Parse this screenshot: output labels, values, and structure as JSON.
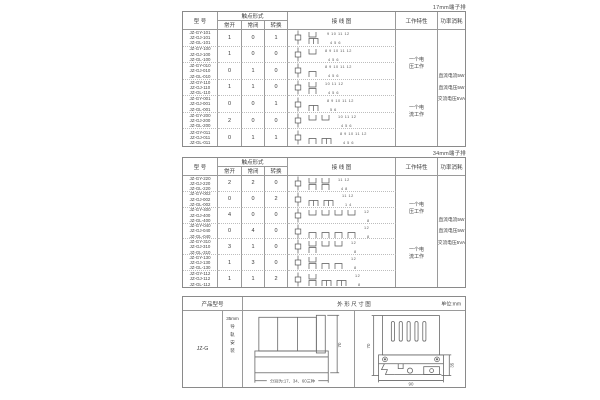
{
  "colors": {
    "border": "#8a8a8a",
    "grid_line": "#9a9a9a",
    "dotted_line": "#bdbdbd",
    "text": "#3a3a3a",
    "diagram": "#555555"
  },
  "spec_headers": {
    "model": "型 号",
    "contact": "触点形式",
    "no": "常开",
    "nc": "常闭",
    "co": "转换",
    "wiring": "接 线 图",
    "working": "工作特性",
    "power": "功率消耗"
  },
  "tables": [
    {
      "note": "17mm端子排",
      "rows": [
        {
          "models": [
            "JZ-GY-101",
            "JZ-GJ-101",
            "JZ-GL-101"
          ],
          "no": "1",
          "nc": "0",
          "co": "1",
          "diagram": {
            "no": 1,
            "nc": 0,
            "co": 1,
            "top_terminals": "9 10 11 12",
            "bottom_terminals": "4 5 6"
          }
        },
        {
          "models": [
            "JZ-GY-100",
            "JZ-GJ-100",
            "JZ-GL-100"
          ],
          "no": "1",
          "nc": "0",
          "co": "0",
          "diagram": {
            "no": 1,
            "nc": 0,
            "co": 0,
            "top_terminals": "8 9 10 11 12",
            "bottom_terminals": "4 5 6"
          }
        },
        {
          "models": [
            "JZ-GY-010",
            "JZ-GJ-010",
            "JZ-GL-010"
          ],
          "no": "0",
          "nc": "1",
          "co": "0",
          "diagram": {
            "no": 0,
            "nc": 1,
            "co": 0,
            "top_terminals": "8 9 10 11 12",
            "bottom_terminals": "4 5 6"
          }
        },
        {
          "models": [
            "JZ-GY-110",
            "JZ-GJ-110",
            "JZ-GL-110"
          ],
          "no": "1",
          "nc": "1",
          "co": "0",
          "diagram": {
            "no": 1,
            "nc": 1,
            "co": 0,
            "top_terminals": "10 11 12",
            "bottom_terminals": "4 5 6"
          }
        },
        {
          "models": [
            "JZ-GY-001",
            "JZ-GJ-001",
            "JZ-GL-001"
          ],
          "no": "0",
          "nc": "0",
          "co": "1",
          "diagram": {
            "no": 0,
            "nc": 0,
            "co": 1,
            "top_terminals": "8 9 10 11 12",
            "bottom_terminals": "5 6"
          }
        },
        {
          "models": [
            "JZ-GY-200",
            "JZ-GJ-200",
            "JZ-GL-200"
          ],
          "no": "2",
          "nc": "0",
          "co": "0",
          "diagram": {
            "no": 2,
            "nc": 0,
            "co": 0,
            "top_terminals": "10 11 12",
            "bottom_terminals": "4 5 6"
          }
        },
        {
          "models": [
            "JZ-GY-011",
            "JZ-GJ-011",
            "JZ-GL-011"
          ],
          "no": "0",
          "nc": "1",
          "co": "1",
          "diagram": {
            "no": 0,
            "nc": 1,
            "co": 1,
            "top_terminals": "8 9 10 11 12",
            "bottom_terminals": "4 5 6"
          }
        }
      ],
      "working": [
        [
          "一个电",
          "压工作"
        ],
        [
          "一个电",
          "流工作"
        ]
      ],
      "power": [
        "直流电流5W",
        "直流电压5W",
        "交流电压5VA"
      ]
    },
    {
      "note": "34mm端子排",
      "rows": [
        {
          "models": [
            "JZ-GY-220",
            "JZ-GJ-220",
            "JZ-GL-220"
          ],
          "no": "2",
          "nc": "2",
          "co": "0",
          "diagram": {
            "no": 2,
            "nc": 2,
            "co": 0,
            "top_terminals": "11 12",
            "bottom_terminals": "4 8"
          }
        },
        {
          "models": [
            "JZ-GY-002",
            "JZ-GJ-002",
            "JZ-GL-002"
          ],
          "no": "0",
          "nc": "0",
          "co": "2",
          "diagram": {
            "no": 0,
            "nc": 0,
            "co": 2,
            "top_terminals": "11 12",
            "bottom_terminals": "1 4"
          }
        },
        {
          "models": [
            "JZ-GY-400",
            "JZ-GJ-400",
            "JZ-GL-400"
          ],
          "no": "4",
          "nc": "0",
          "co": "0",
          "diagram": {
            "no": 4,
            "nc": 0,
            "co": 0,
            "top_terminals": "12",
            "bottom_terminals": "8"
          }
        },
        {
          "models": [
            "JZ-GY-040",
            "JZ-GJ-040",
            "JZ-GL-040"
          ],
          "no": "0",
          "nc": "4",
          "co": "0",
          "diagram": {
            "no": 0,
            "nc": 4,
            "co": 0,
            "top_terminals": "12",
            "bottom_terminals": "8"
          }
        },
        {
          "models": [
            "JZ-GY-310",
            "JZ-GJ-310",
            "JZ-GL-310"
          ],
          "no": "3",
          "nc": "1",
          "co": "0",
          "diagram": {
            "no": 3,
            "nc": 1,
            "co": 0,
            "top_terminals": "12",
            "bottom_terminals": "8"
          }
        },
        {
          "models": [
            "JZ-GY-130",
            "JZ-GJ-130",
            "JZ-GL-130"
          ],
          "no": "1",
          "nc": "3",
          "co": "0",
          "diagram": {
            "no": 1,
            "nc": 3,
            "co": 0,
            "top_terminals": "12",
            "bottom_terminals": "8"
          }
        },
        {
          "models": [
            "JZ-GY-112",
            "JZ-GJ-112",
            "JZ-GL-112"
          ],
          "no": "1",
          "nc": "1",
          "co": "2",
          "diagram": {
            "no": 1,
            "nc": 1,
            "co": 2,
            "top_terminals": "12",
            "bottom_terminals": "8"
          }
        }
      ],
      "working": [
        [
          "一个电",
          "压工作"
        ],
        [
          "一个电",
          "流工作"
        ]
      ],
      "power": [
        "直流电流5W",
        "直流电压5W",
        "交流电压5VA"
      ]
    }
  ],
  "outline": {
    "product_header": "产品型号",
    "dimension_header": "外 形 尺 寸 图",
    "unit": "单位:mm",
    "model": "JZ-G",
    "mount": [
      "35mm",
      "导",
      "轨",
      "安",
      "装"
    ],
    "front_caption": "分别为:17、34、60三种",
    "front_height": "70",
    "side_height": "70",
    "side_width": "90",
    "side_clip": "35"
  }
}
